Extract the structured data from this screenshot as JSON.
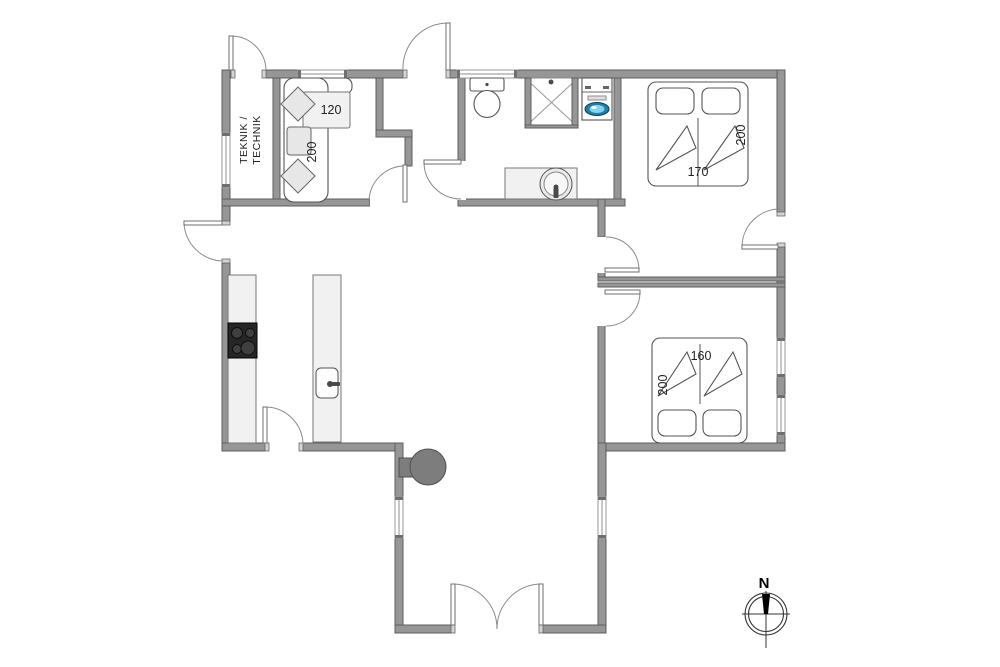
{
  "labels": {
    "teknik_line1": "TEKNIK /",
    "teknik_line2": "TECHNIK",
    "sofa_bed_width": "120",
    "sofa_bed_length": "200",
    "bed1_width": "170",
    "bed1_length": "200",
    "bed2_width": "160",
    "bed2_length": "200",
    "compass_north": "N"
  },
  "colors": {
    "wall": "#969696",
    "wall_outline": "#5e5e5e",
    "furniture_outline": "#555555",
    "light_fill": "#f1f1f1",
    "cooktop": "#262626",
    "stove": "#7d7d7d",
    "washer_door_outer": "#1f7fa8",
    "washer_door_inner": "#7fd4ef",
    "text": "#222222"
  }
}
